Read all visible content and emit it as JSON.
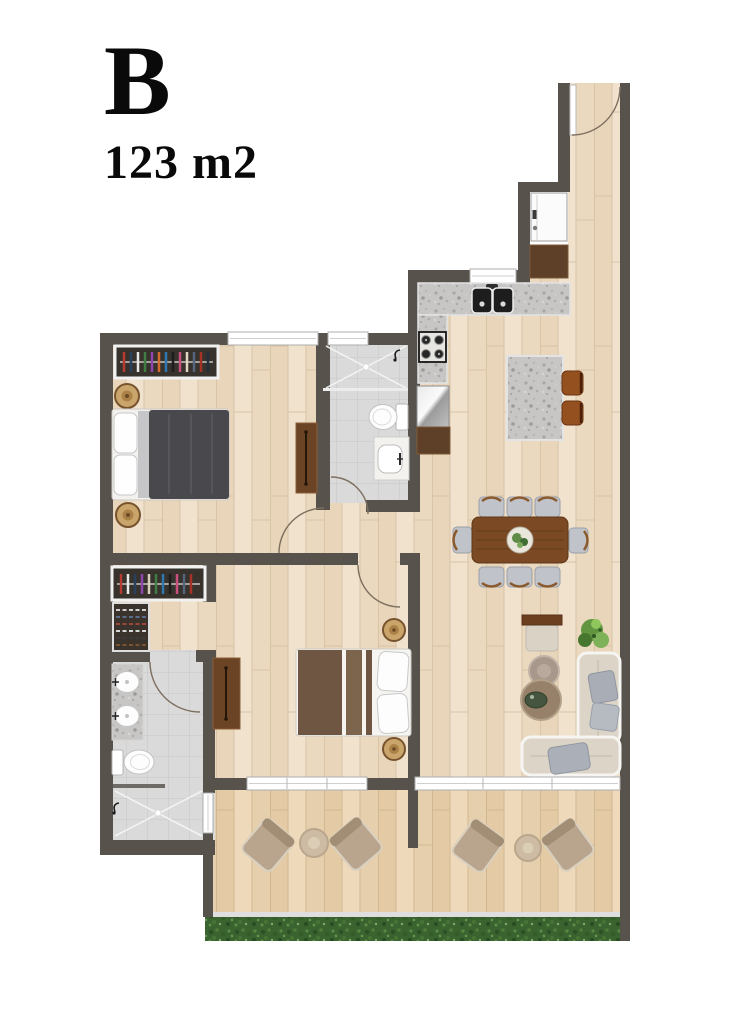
{
  "header": {
    "title": "B",
    "subtitle": "123 m2"
  },
  "plan": {
    "unit_label": "B",
    "area_label": "123 m2",
    "colors": {
      "wall": "#57524c",
      "wood_floor": "#ecdcc5",
      "terrace_floor": "#e8d2b2",
      "tile_floor": "#dadada",
      "granite_counter": "#c7c6c4",
      "furniture_brown": "#6b4426",
      "dining_table_brown": "#7b4a24",
      "duvet_dark": "#48484d",
      "sofa_fabric": "#dbd4c7",
      "lounge_chair_taupe": "#b9a58d",
      "hedge_green": "#3a6330",
      "window_white": "#ffffff"
    },
    "furniture_icons": [
      "entry-door-arc-icon",
      "washing-machine-icon",
      "hall-cabinet-icon",
      "kitchen-counter-icon",
      "double-sink-icon",
      "stove-icon",
      "fridge-icon",
      "kitchen-island-icon",
      "bar-stool-icon",
      "dining-table-icon",
      "dining-chair-icon",
      "desk-icon",
      "plant-icon",
      "coffee-table-icon",
      "sofa-icon",
      "pillow-icon",
      "wardrobe-icon",
      "double-bed-icon",
      "rug-icon",
      "dresser-icon",
      "shoe-rack-icon",
      "shower-icon",
      "toilet-icon",
      "washbasin-icon",
      "double-vanity-icon",
      "lounge-chair-icon",
      "side-table-icon",
      "hedge-icon",
      "window-icon",
      "door-arc-icon"
    ]
  }
}
